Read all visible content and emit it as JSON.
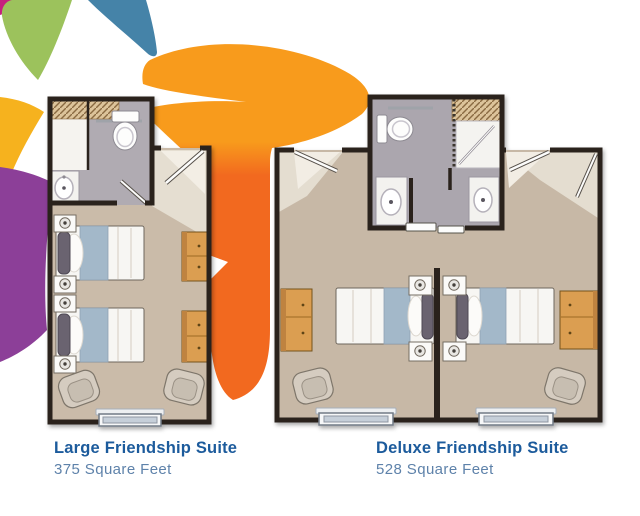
{
  "captions": [
    {
      "title": "Large Friendship Suite",
      "subtitle": "375 Square Feet"
    },
    {
      "title": "Deluxe Friendship Suite",
      "subtitle": "528 Square Feet"
    }
  ],
  "palette": {
    "title_blue": "#1c5b9c",
    "subtitle_blue": "#5e82aa",
    "petal_magenta": "#c6207e",
    "petal_green": "#9cc25c",
    "petal_teal": "#4583a8",
    "petal_yellow": "#f6b21e",
    "petal_purple": "#8c3f98",
    "swoosh_orange_light": "#f89b1c",
    "swoosh_orange_deep": "#f2691f",
    "wall": "#2a241e",
    "carpet": "#c9baa8",
    "bath_floor": "#aeaab1",
    "entry_tile": "#e5ded1",
    "wood": "#db9e51",
    "blanket_blue": "#a3b8c9"
  }
}
